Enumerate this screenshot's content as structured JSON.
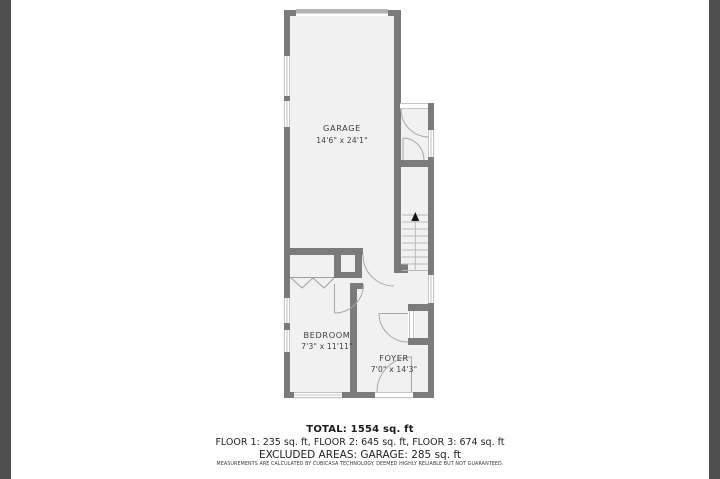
{
  "viewer": {
    "edge_bar_color": "#4f4f4f"
  },
  "floorplan": {
    "colors": {
      "wall": "#7b7b7b",
      "room_fill": "#f1f1f1",
      "garage_door": "#b3b3b3",
      "line": "#a8a8a8"
    },
    "rooms": [
      {
        "name": "GARAGE",
        "dimensions": "14'6\" x 24'1\""
      },
      {
        "name": "BEDROOM",
        "dimensions": "7'3\" x 11'11\""
      },
      {
        "name": "FOYER",
        "dimensions": "7'0\" x 14'3\""
      }
    ],
    "stairs": {
      "direction": "up"
    }
  },
  "summary": {
    "total": "TOTAL: 1554 sq. ft",
    "floors": "FLOOR 1: 235 sq. ft, FLOOR 2: 645 sq. ft, FLOOR 3: 674 sq. ft",
    "excluded": "EXCLUDED AREAS: GARAGE: 285 sq. ft",
    "disclaimer": "MEASUREMENTS ARE CALCULATED BY CUBICASA TECHNOLOGY. DEEMED HIGHLY RELIABLE BUT NOT GUARANTEED."
  }
}
